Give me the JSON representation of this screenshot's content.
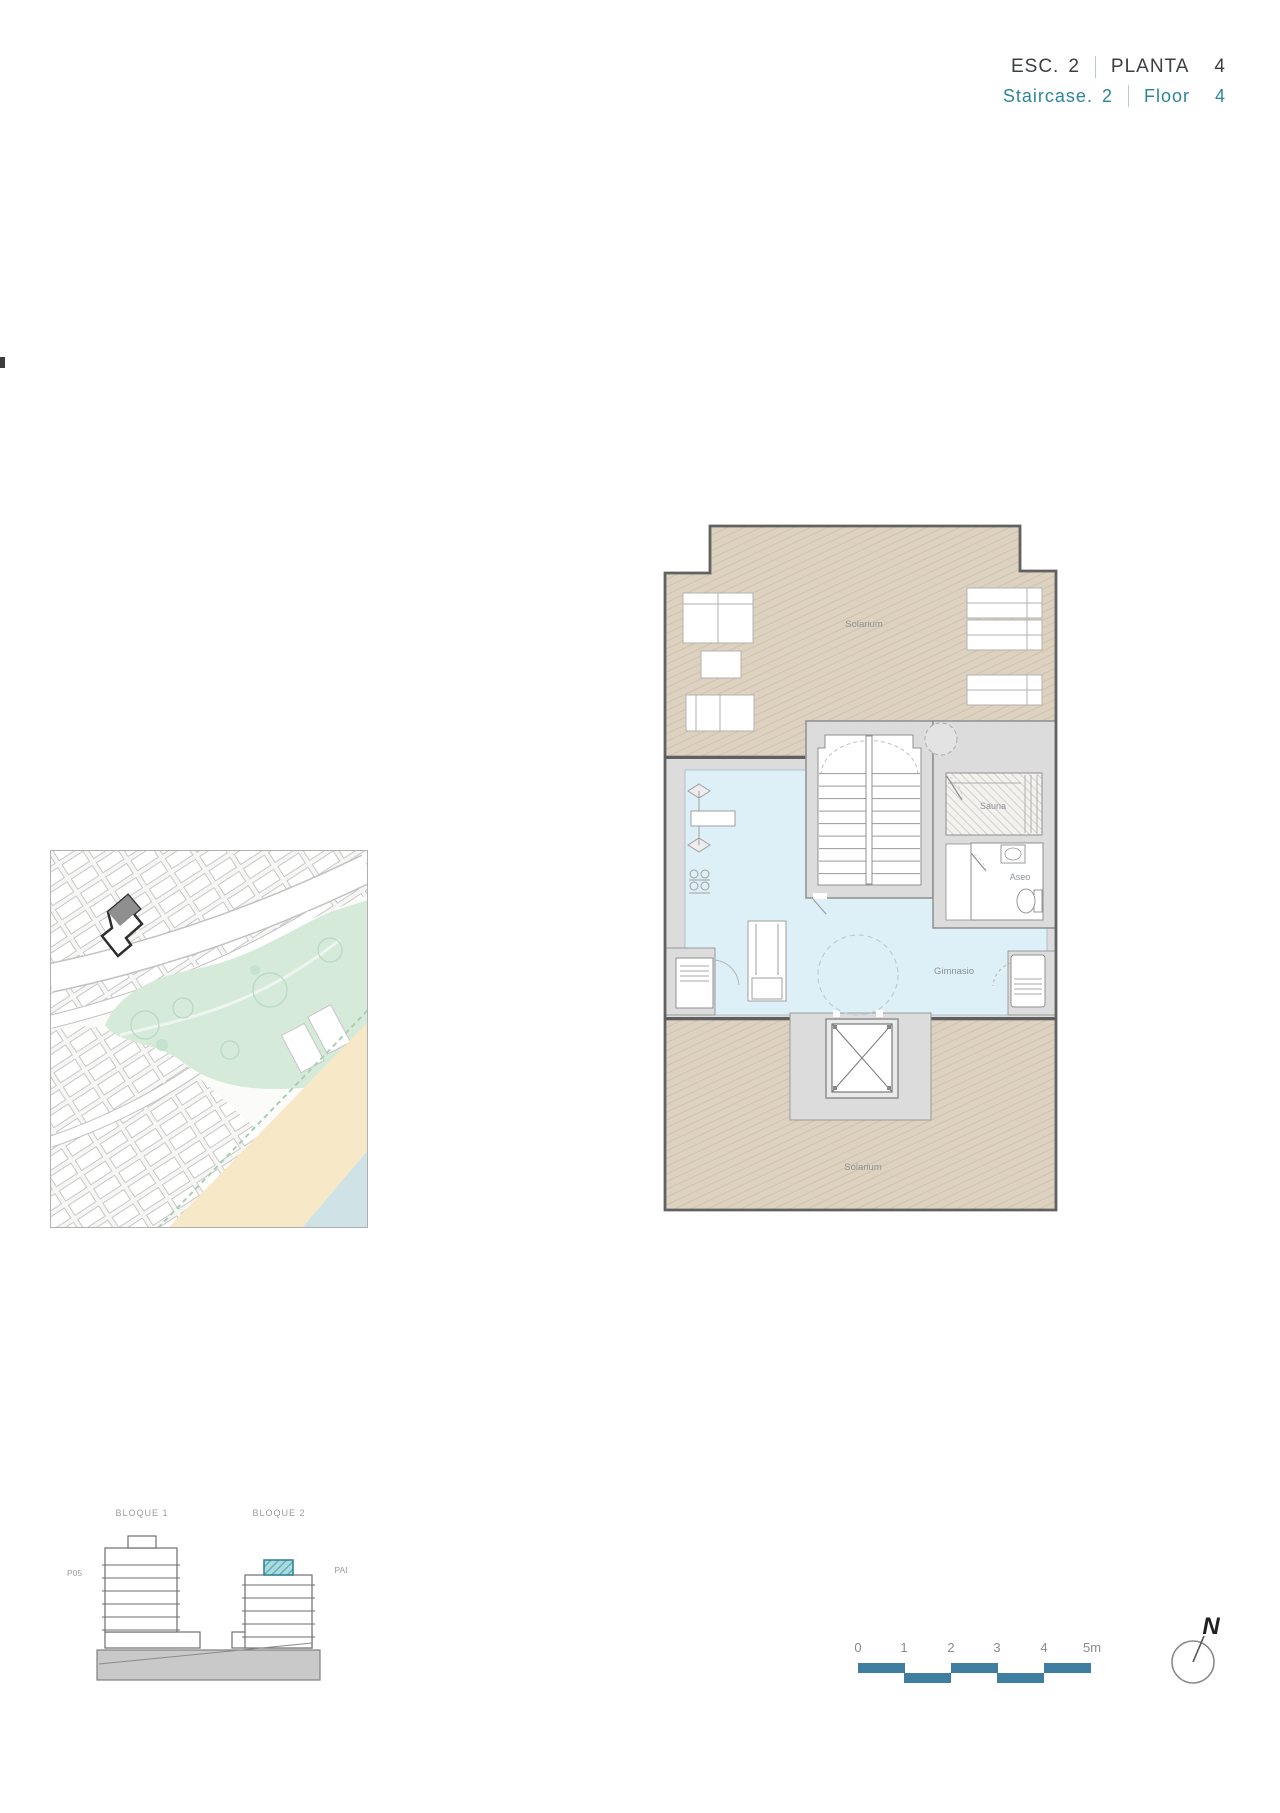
{
  "title": {
    "esc_label": "ESC.",
    "esc_number": "2",
    "planta_label": "PLANTA",
    "planta_number": "4",
    "staircase_label": "Staircase.",
    "staircase_number": "2",
    "floor_label": "Floor",
    "floor_number": "4"
  },
  "plan": {
    "labels": {
      "solarium_top": "Solarium",
      "solarium_bottom": "Solarium",
      "gym": "Gimnasio",
      "sauna": "Sauna",
      "aseo": "Aseo"
    }
  },
  "elevation": {
    "bloque1": "BLOQUE 1",
    "bloque2": "BLOQUE 2",
    "left_mark": "P05",
    "right_mark": "PAI"
  },
  "scalebar": {
    "ticks": [
      "0",
      "1",
      "2",
      "3",
      "4",
      "5m"
    ]
  },
  "compass": {
    "north": "N"
  },
  "colors": {
    "title_dark": "#3c4043",
    "teal_text": "#2c8699",
    "scalebar_teal": "#3f7ea0",
    "solarium_tan": "#ddd2c0",
    "solarium_hatch": "#d0c3ae",
    "gym_blue": "#def0f7",
    "wall_gray": "#dcdcdc",
    "park_green": "#d5ead9",
    "beach_sand": "#f7e9c7",
    "sea_blue": "#cfe3e7",
    "elevation_teal_fill": "#aadbe0",
    "elevation_teal_border": "#2f7f8e"
  }
}
